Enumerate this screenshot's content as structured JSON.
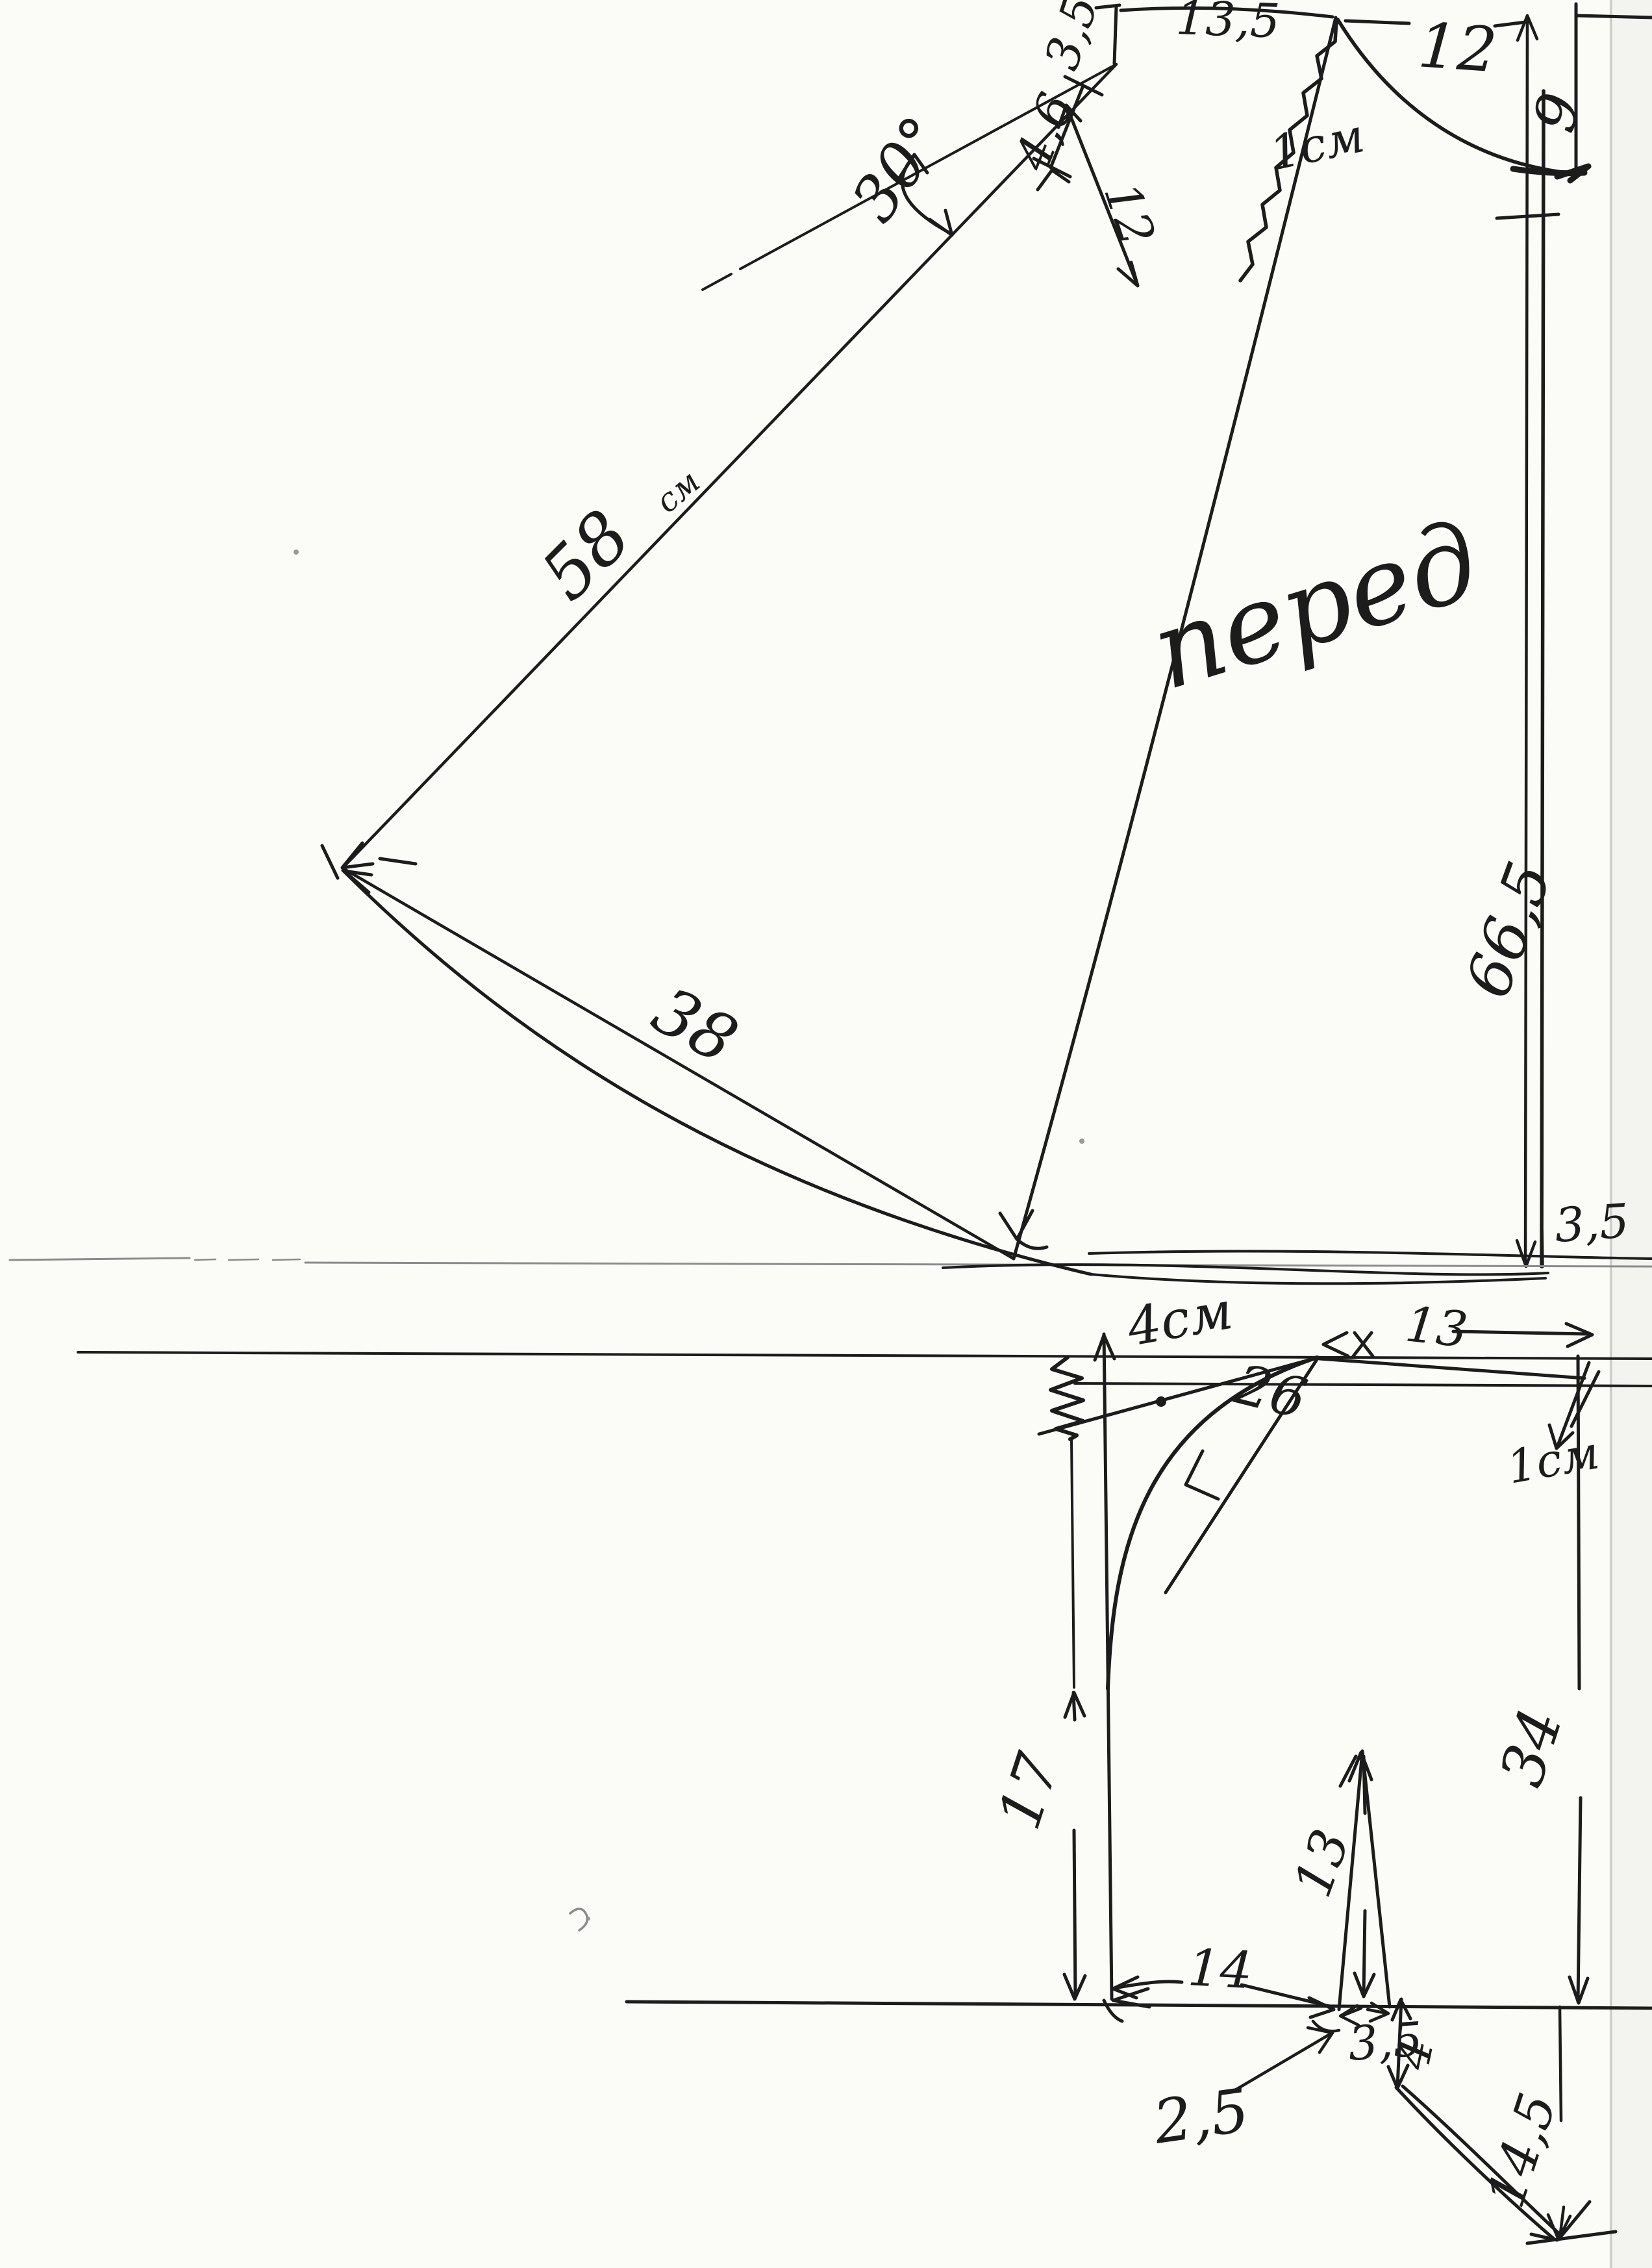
{
  "document": {
    "kind": "hand-drawn sewing pattern draft (scan)",
    "language": "Russian",
    "piece_name": "перед"
  },
  "colors": {
    "ink": "#1c1c1c",
    "pencil": "#8b8b8b",
    "paper": "#fbfbf8",
    "faint": "#c9c9c5"
  },
  "top": {
    "shoulder_width": "13,5",
    "shoulder_ext": "3,5",
    "dart_offset": "4,6",
    "flare_angle": "30°",
    "dart_length": "12",
    "ease_note": "1см",
    "neck_width": "12",
    "neck_depth": "9",
    "side_length": "58",
    "side_length_unit": "см",
    "piece_name": "перед",
    "center_front_length": "66,5",
    "hem_half_width": "38",
    "hem_rise": "3,5"
  },
  "bottom": {
    "waist_note": "4см",
    "hip_curve_length": "26",
    "top_width": "13",
    "drop_note": "1см",
    "side_length": "34",
    "upper_side_length": "17",
    "dart_length": "13",
    "waist_segment": "14",
    "dart_width": "3,5",
    "leader_note": "2,5",
    "hem_step": "4",
    "flare_length": "14,5"
  }
}
